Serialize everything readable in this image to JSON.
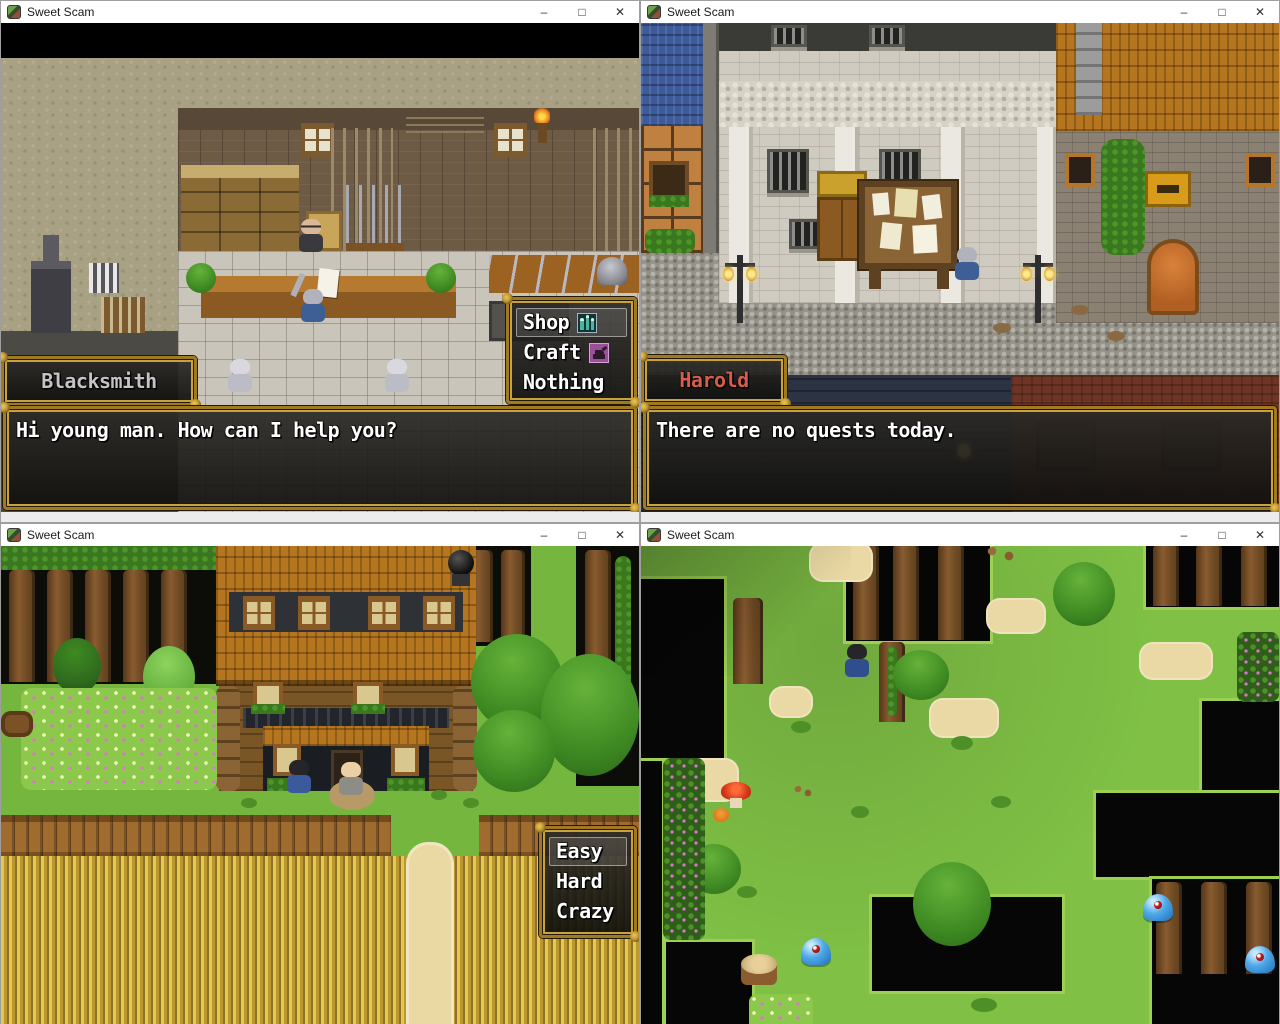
{
  "app": {
    "title": "Sweet Scam",
    "icon": "app-icon"
  },
  "window_controls": {
    "minimize": "–",
    "maximize": "□",
    "close": "✕"
  },
  "colors": {
    "frame_gold": "#c9a23b",
    "speaker_blacksmith": "#c4c4c4",
    "speaker_harold": "#d85c4a",
    "dialogue_text": "#ffffff",
    "slime_blue": "#4fa8e8",
    "grass_green": "#7fc045"
  },
  "windows": [
    {
      "title": "Sweet Scam",
      "scene": "blacksmith-shop-interior",
      "speaker": "Blacksmith",
      "dialogue": "Hi young man. How can I help you?",
      "menu": {
        "selected": "Shop",
        "items": [
          {
            "label": "Shop",
            "icon": "shop-potions-icon"
          },
          {
            "label": "Craft",
            "icon": "craft-anvil-icon"
          },
          {
            "label": "Nothing",
            "icon": ""
          }
        ]
      }
    },
    {
      "title": "Sweet Scam",
      "scene": "town-street-quest-board",
      "speaker": "Harold",
      "dialogue": "There are no quests today."
    },
    {
      "title": "Sweet Scam",
      "scene": "farm-house-fields",
      "menu": {
        "selected": "Easy",
        "items": [
          {
            "label": "Easy",
            "icon": ""
          },
          {
            "label": "Hard",
            "icon": ""
          },
          {
            "label": "Crazy",
            "icon": ""
          }
        ]
      }
    },
    {
      "title": "Sweet Scam",
      "scene": "forest-maze-slimes"
    }
  ]
}
